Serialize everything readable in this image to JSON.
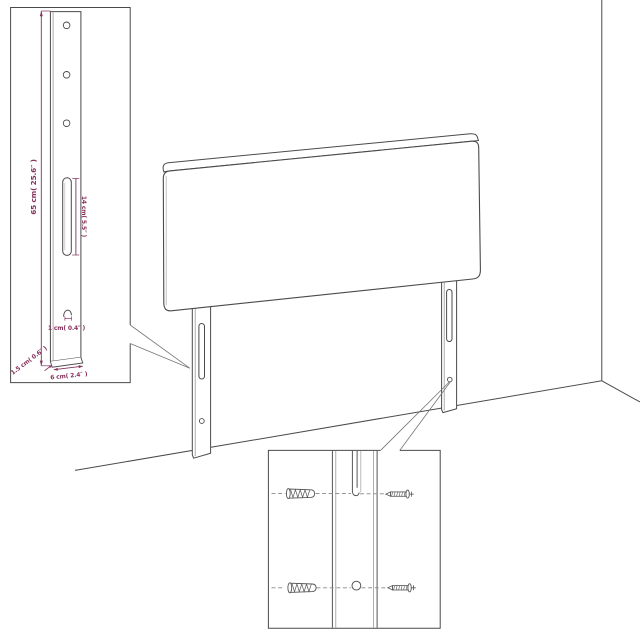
{
  "colors": {
    "outline": "#4a4a4a",
    "outline_light": "#9a9a9a",
    "dimension": "#86325c",
    "background": "#ffffff"
  },
  "figures": [
    "headboard-panel",
    "headboard-left-leg",
    "headboard-right-leg",
    "wall-corner",
    "leg-detail-inset",
    "mounting-detail-inset"
  ],
  "leg_detail_inset": {
    "labels": {
      "height": "65 cm( 25.6″ )",
      "slot_length": "14 cm( 5.5″ )",
      "hook": "1 cm( 0.4″ )",
      "depth": "1.5 cm( 0.6″ )",
      "width": "6 cm( 2.4″ )"
    }
  },
  "mounting_detail_inset": {
    "icons": [
      "wall-plug-icon",
      "wall-plug-icon",
      "screw-icon",
      "screw-icon"
    ]
  }
}
